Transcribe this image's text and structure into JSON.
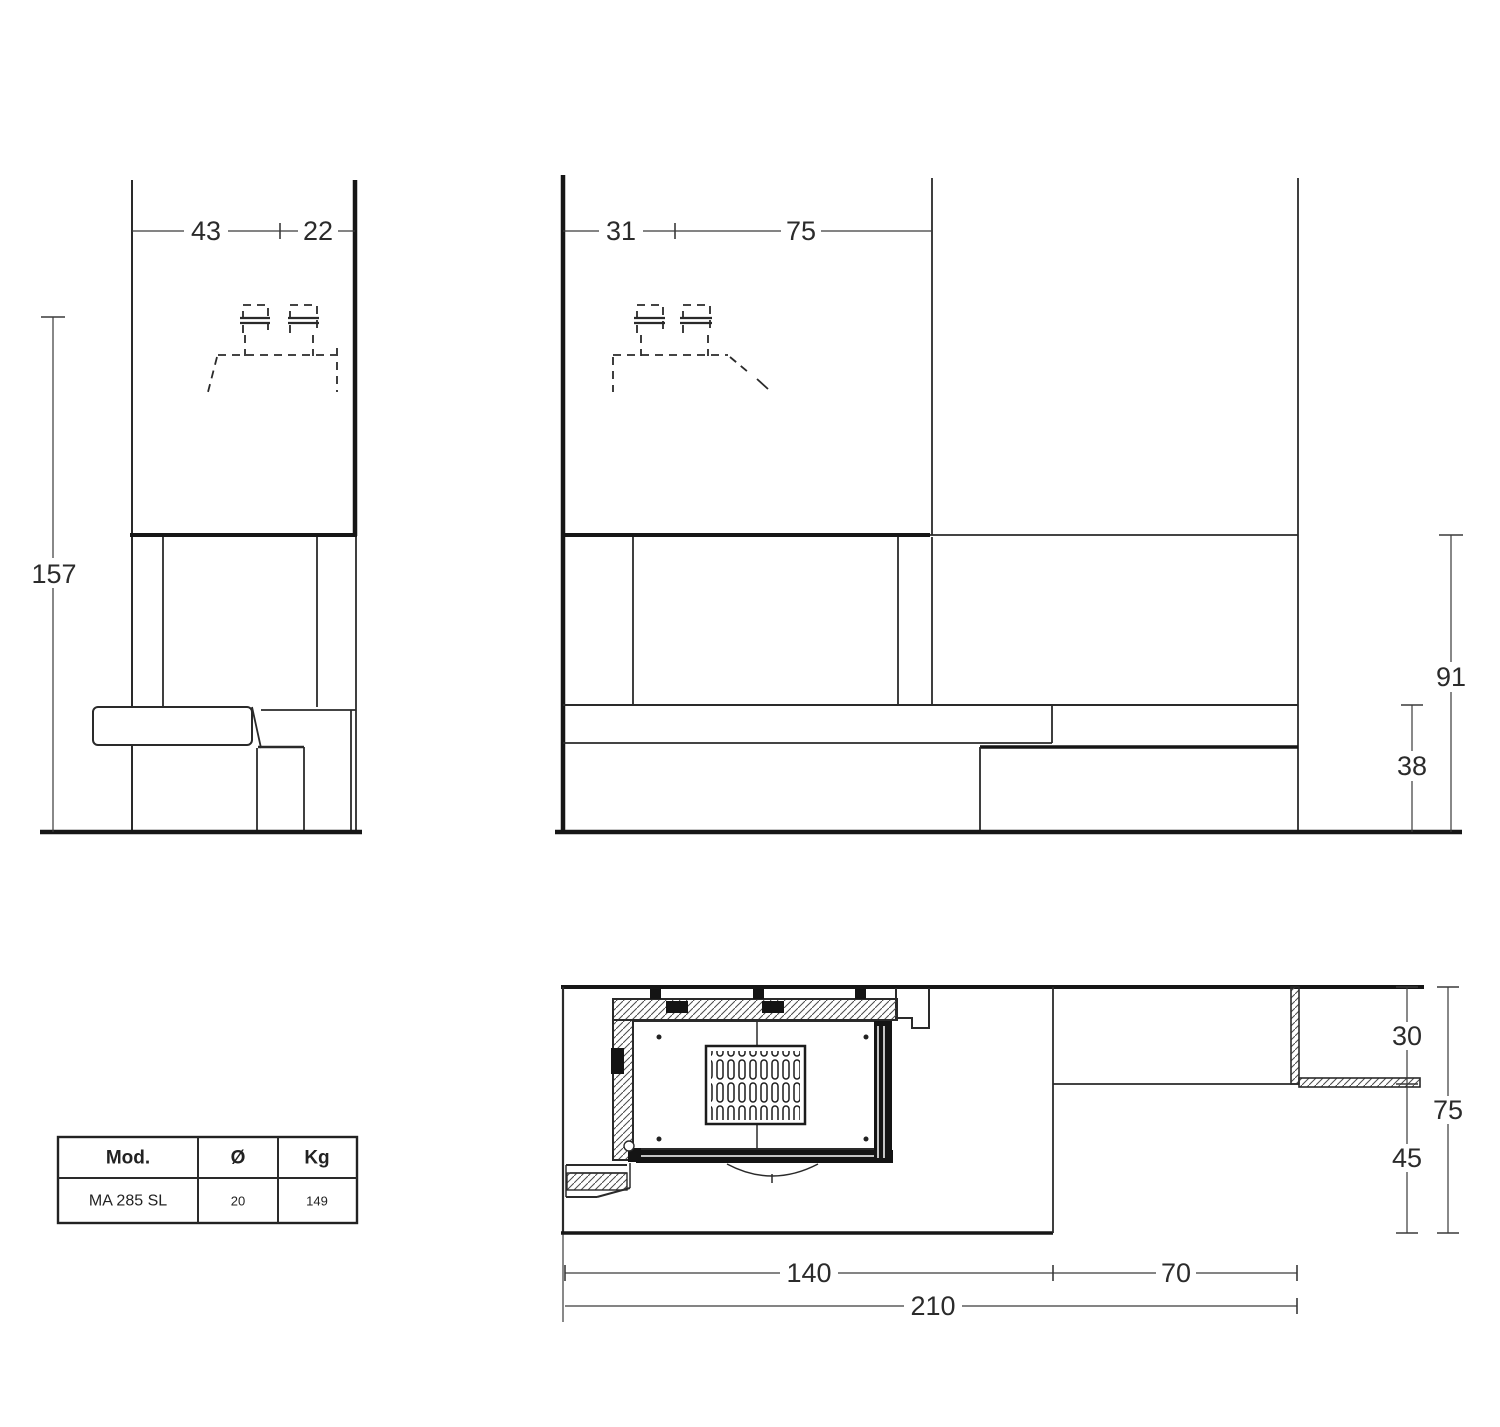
{
  "drawing": {
    "title": "fireplace-technical-drawing",
    "side_view": {
      "dim_top_width_back": "43",
      "dim_top_width_front": "22",
      "dim_total_height": "157"
    },
    "front_view": {
      "dim_top_left_width": "31",
      "dim_top_opening_width": "75",
      "dim_hood_height": "91",
      "dim_bench_height": "38"
    },
    "plan_view": {
      "dim_right_wall_depth": "30",
      "dim_right_front_depth": "45",
      "dim_total_depth": "75",
      "dim_body_width": "140",
      "dim_side_bench_width": "70",
      "dim_total_width": "210"
    }
  },
  "spec_table": {
    "headers": [
      "Mod.",
      "Ø",
      "Kg"
    ],
    "rows": [
      [
        "MA 285 SL",
        "20",
        "149"
      ]
    ]
  }
}
